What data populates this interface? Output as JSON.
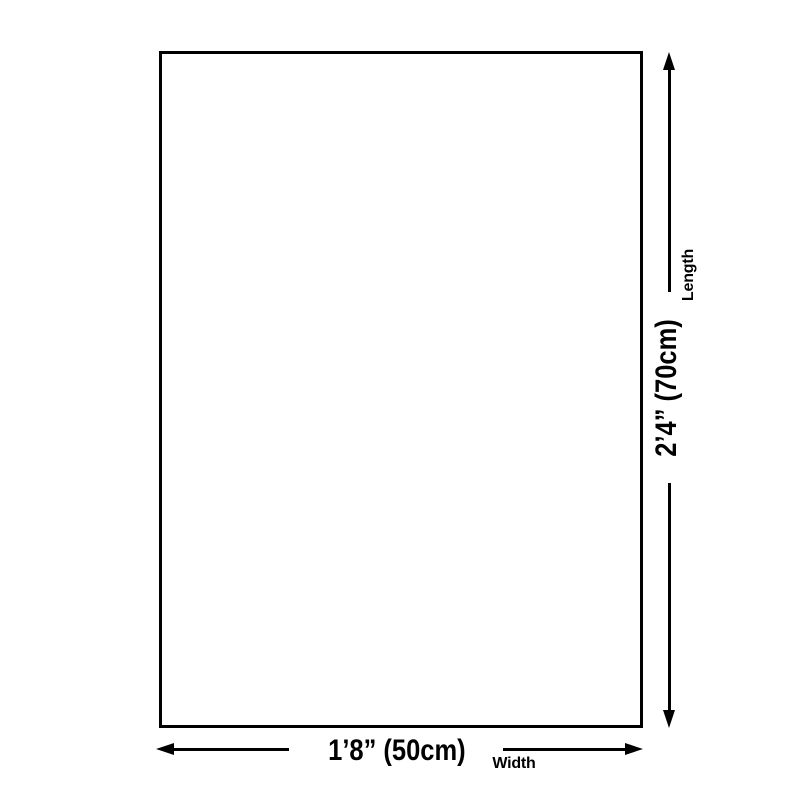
{
  "diagram": {
    "type": "product-size-dimension-diagram",
    "colors": {
      "background": "#ffffff",
      "line": "#000000",
      "text": "#000000",
      "panel_fill": "#ffffff"
    },
    "panel": {
      "shape": "rectangle"
    },
    "width_dimension": {
      "value": "1’8” (50cm)",
      "label": "Width"
    },
    "length_dimension": {
      "value": "2’4” (70cm)",
      "label": "Length"
    }
  }
}
